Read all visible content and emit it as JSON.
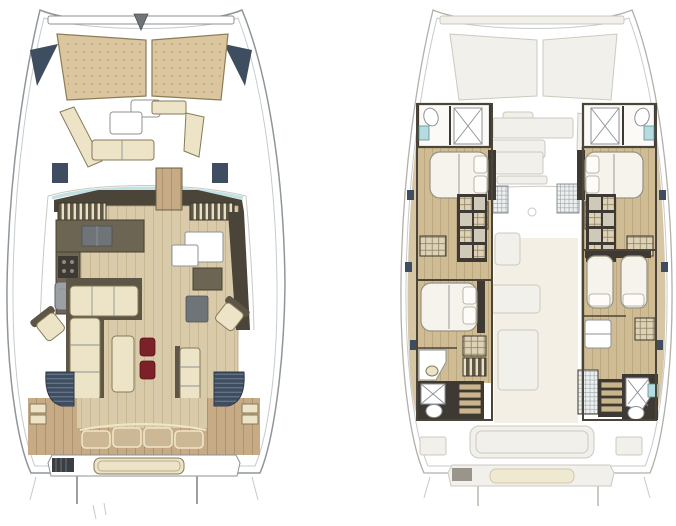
{
  "canvas": {
    "width": 676,
    "height": 526,
    "background": "#ffffff"
  },
  "figure": {
    "kind": "catamaran-yacht-floorplan",
    "plans": [
      {
        "id": "deck-plan",
        "position": "left"
      },
      {
        "id": "cabin-plan",
        "position": "right"
      }
    ]
  },
  "colors": {
    "hullFill": "#ffffff",
    "hullStroke": "#8f969b",
    "hullInner": "#c6cbce",
    "ghostFill": "#f2f0ea",
    "ghostStroke": "#ccc9c0",
    "sunpad": "#dbc69f",
    "sunpadEdge": "#8d7c55",
    "sunpadDot": "#c2aa7d",
    "navy": "#3e4d60",
    "wallDark": "#4a4538",
    "counterOlive": "#6d6553",
    "woodLight": "#d9cba9",
    "woodLine": "#c4b28b",
    "teak": "#c6ab86",
    "teakLine": "#a88e66",
    "floorTan": "#cfbc94",
    "floorTanLine": "#b7a379",
    "cream": "#ede4c8",
    "creamEdge": "#857a58",
    "red": "#7c2127",
    "grayItem": "#6f7478",
    "teal": "#b5dde0",
    "bedFill": "#f5f3ec",
    "bedEdge": "#97927f",
    "hatchBase": "#ddd2b6",
    "hatchLine": "#8d8264",
    "gridBase": "#edf0f0",
    "gridLine": "#9aa4a6",
    "centerTint": "#eae2cf",
    "headDark": "#3e3a33"
  }
}
